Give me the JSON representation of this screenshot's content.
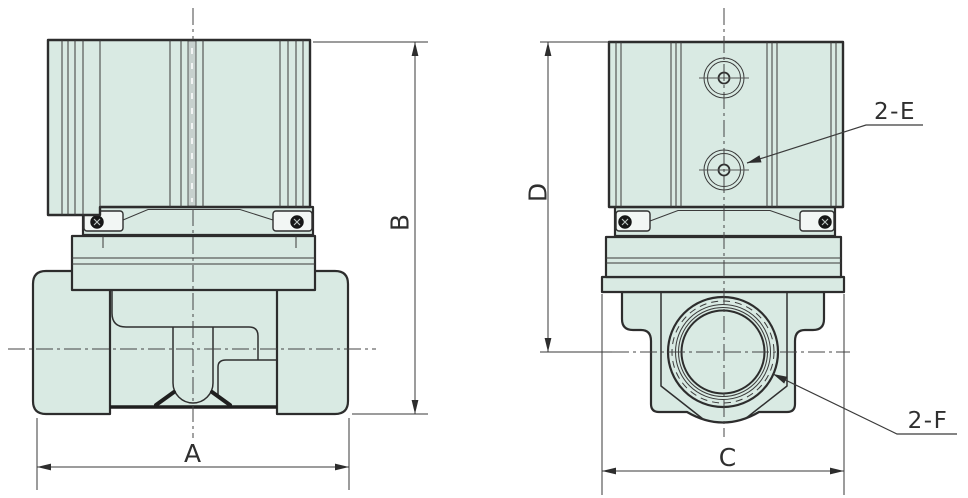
{
  "drawing": {
    "dimension_labels": {
      "a": "A",
      "b": "B",
      "c": "C",
      "d": "D"
    },
    "callouts": {
      "e": "2-E",
      "f": "2-F"
    },
    "colors": {
      "body_fill": "#d9eae3",
      "slot_fill": "#c7d1ce",
      "line": "#2d2d2d",
      "background": "#ffffff"
    }
  }
}
